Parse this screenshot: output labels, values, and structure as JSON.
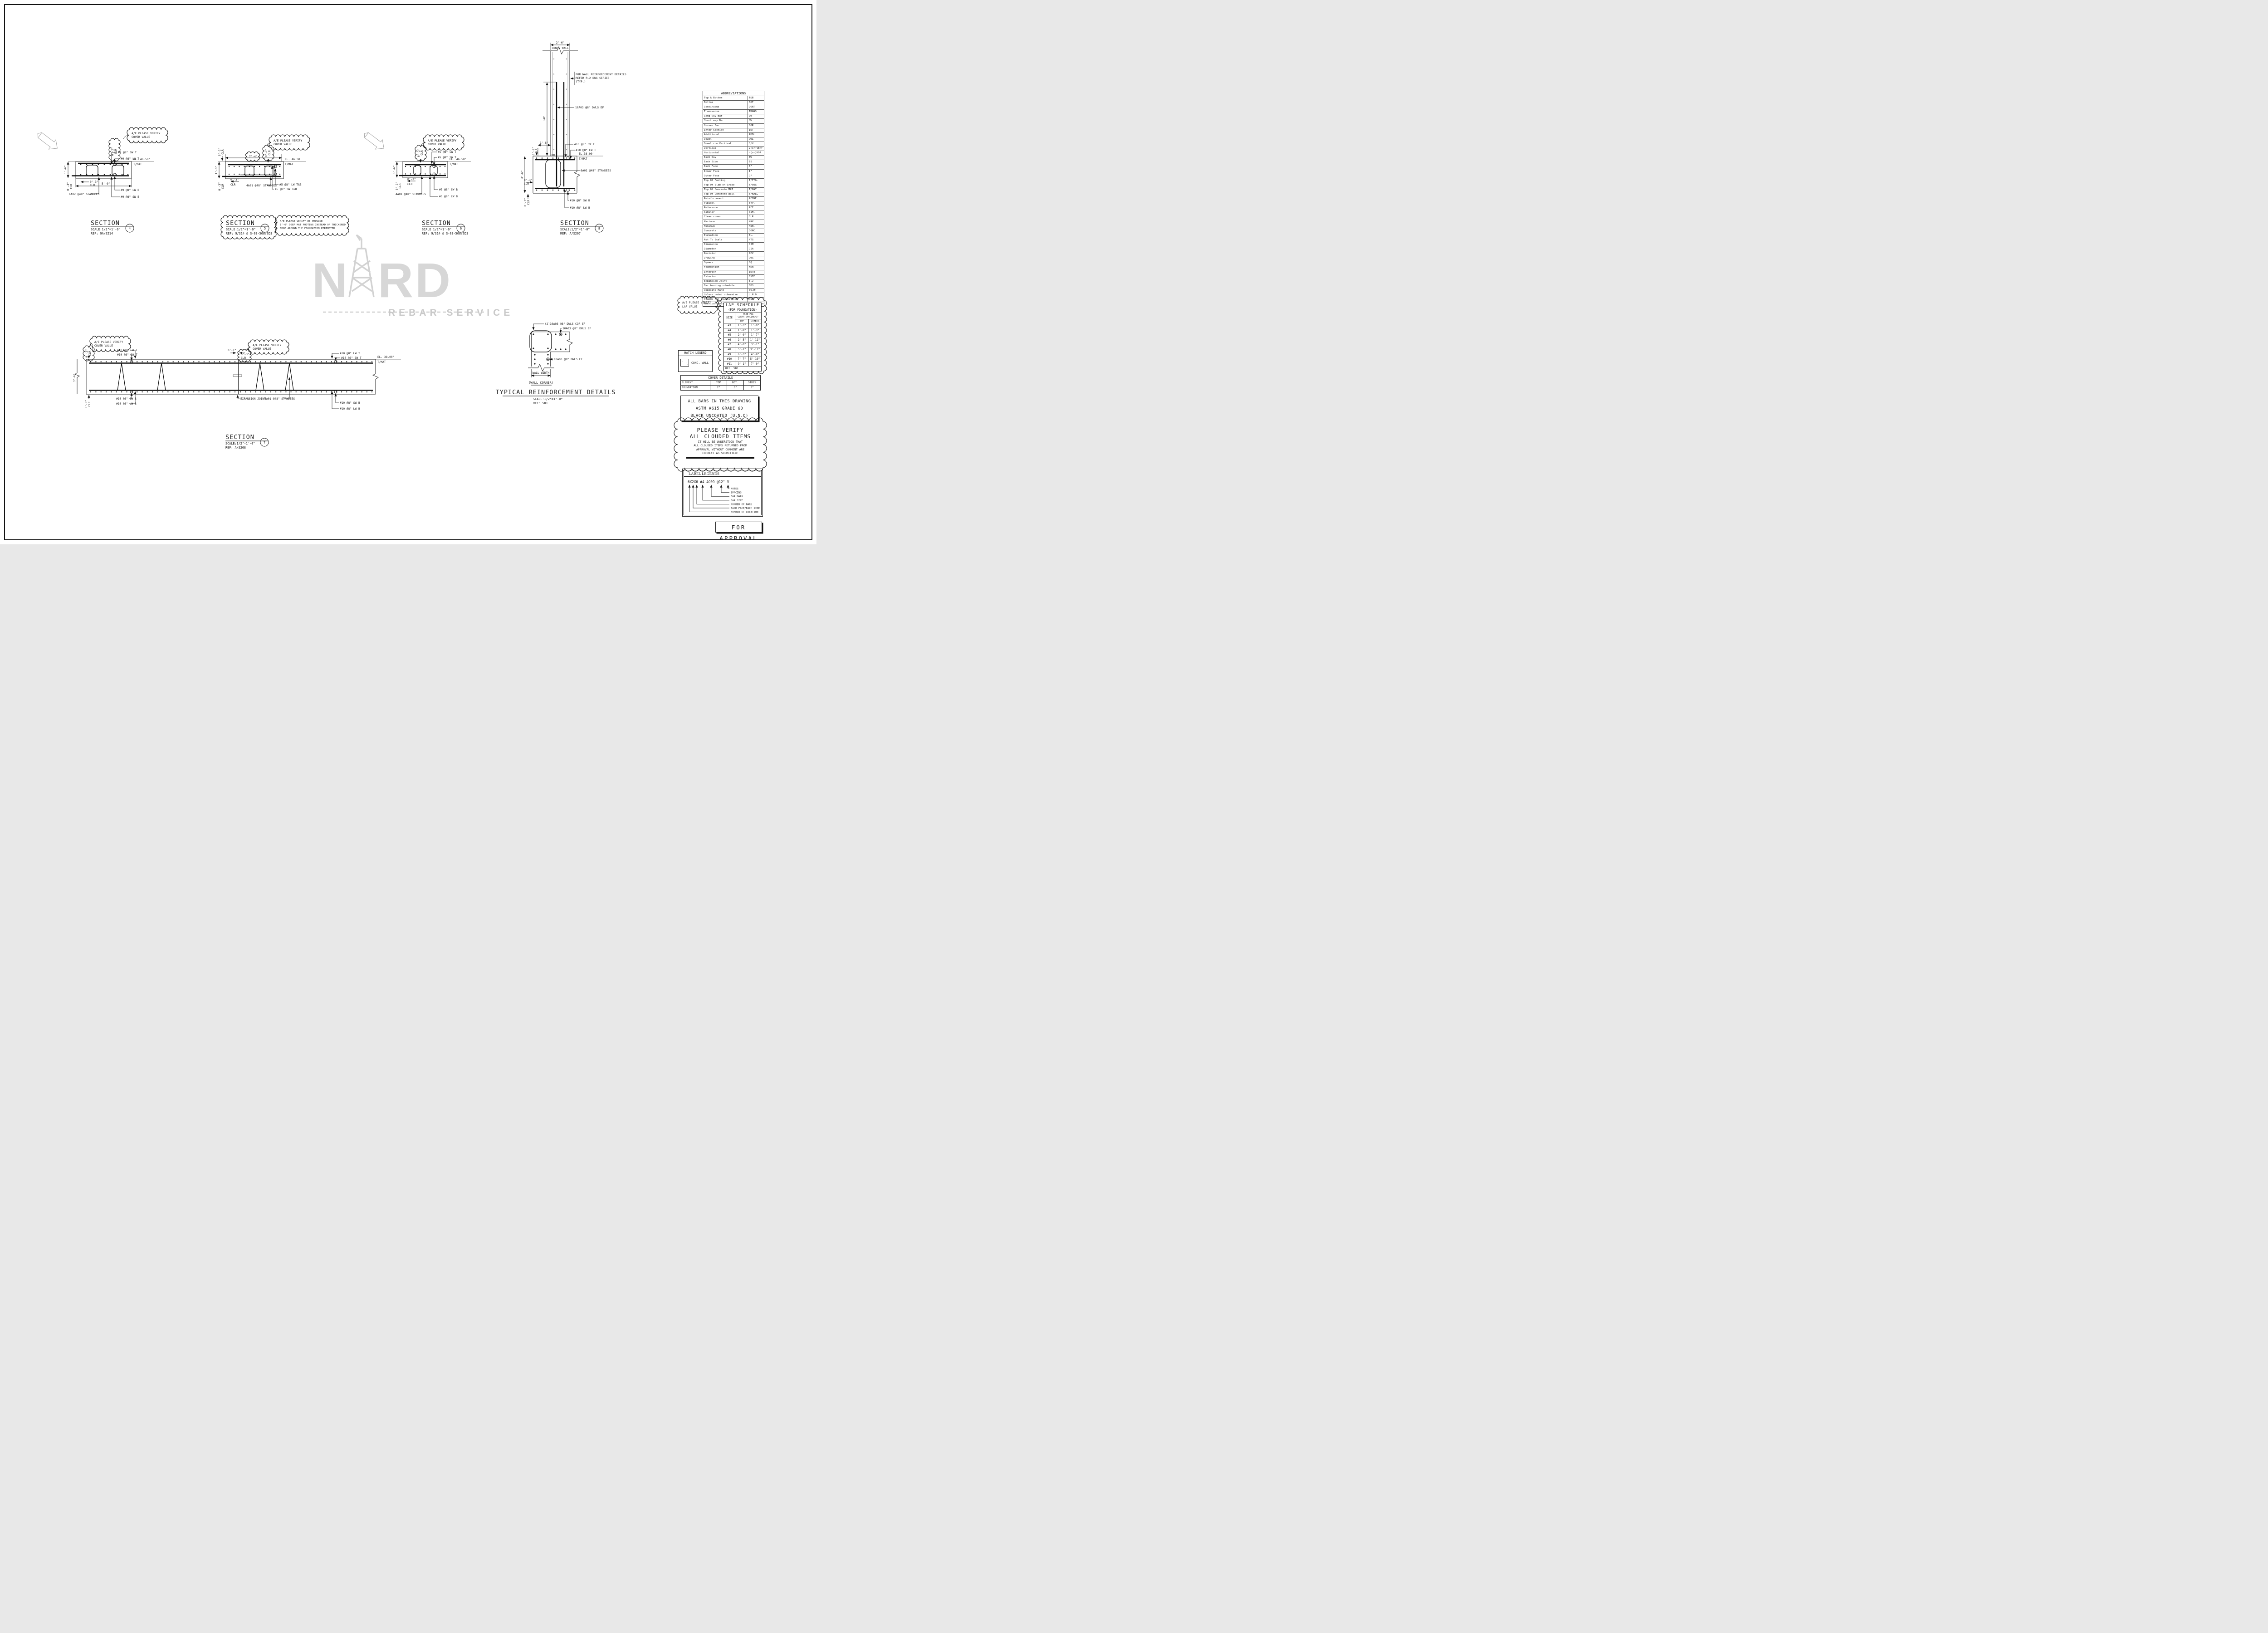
{
  "watermark": {
    "prefix": "N",
    "suffix": "RD",
    "subtitle": "REBAR SERVICE"
  },
  "clouds": {
    "verify1": "A/E PLEASE VERIFY",
    "verify2": "COVER VALUE",
    "lap1": "A/E PLEASE VERIFY",
    "lap2": "LAP VALUE"
  },
  "dims": {
    "clr02": "0'-2\"",
    "clr03": "0'-3\"",
    "clr": "CLR",
    "h16": "1'-6\"",
    "w50": "5'-0\"",
    "w74": "7'-4\"",
    "h36": "3'-6\"",
    "w26": "2'-6\"",
    "w01": "0'-1\"",
    "lap": "LAP",
    "wall_width": "WALL WIDTH"
  },
  "sections": {
    "s4": {
      "name": "SECTION",
      "num": "4",
      "scale": "SCALE:1/2\"=1'-0\"",
      "ref": "REF: 9A/S214",
      "sw_t": "#9 @8\" SW T",
      "lw_t": "#9 @8\" LW T",
      "lw_b": "#9 @8\" LW B",
      "sw_b": "#9 @8\" SW B",
      "standees": "6A02 @48\" STANDEES",
      "el": "EL. 46.50'",
      "tmat": "T/MAT"
    },
    "s5": {
      "name": "SECTION",
      "num": "5",
      "scale": "SCALE:1/2\"=1'-0\"",
      "ref": "REF: 9/S14 & S-03-508/SD3",
      "lw_tb": "#5 @8\" LW T&B",
      "sw_tb": "#5 @8\" SW T&B",
      "standees": "4A01 @48\" STANDEES",
      "el": "EL. 46.50'",
      "tmat": "T/MAT",
      "note1": "A/E PLEASE VERIFY WE PROVIDE",
      "note2": "1'-6\" DEEP MAT FOOTING INSTEAD OF THICKENED",
      "note3": "EDGE AROUND THE FOUNDATION PERIMETER"
    },
    "s6": {
      "name": "SECTION",
      "num": "6",
      "scale": "SCALE:1/2\"=1'-0\"",
      "ref": "REF: 9/S14 & S-03-508/SD3",
      "lw_t": "#5 @8\" LW T",
      "sw_t": "#5 @8\" SW T",
      "sw_b": "#5 @8\" SW B",
      "lw_b": "#5 @8\" LW B",
      "standees": "4A01 @48\" STANDEES",
      "el": "EL. 46.50'",
      "tmat": "T/MAT"
    },
    "s7": {
      "name": "SECTION",
      "num": "7",
      "scale": "SCALE:1/2\"=1'-0\"",
      "ref": "REF: A/S208",
      "lw_t": "#10 @8\" LW T",
      "sw_t": "#10 @8\" SW T",
      "sw_b": "#10 @8\" SW B",
      "lw_b": "#10 @8\" LW B",
      "standees": "6A01 @48\" STANDEES",
      "ej": "EXPANSION JOINT",
      "el": "EL. 38.00'",
      "tmat": "T/MAT"
    },
    "s8": {
      "name": "SECTION",
      "num": "8",
      "scale": "SCALE:1/2\"=1'-0\"",
      "ref": "REF: A/S207",
      "sw_t": "#10 @8\" SW T",
      "lw_t": "#10 @8\" LW T",
      "sw_b": "#10 @8\" SW B",
      "lw_b": "#10 @8\" LW B",
      "standees": "6A01 @48\" STANDEES",
      "dwls": "10A03 @8\" DWLS EF",
      "note1": "FOR WALL REINFORCEMENT DETAILS",
      "note2": "REFER R-2 DWG SERIES",
      "note3": "(TYP.)",
      "conc_wall": "CONC. WALL",
      "el": "EL.38.00'",
      "tmat": "T/MAT"
    },
    "corner": {
      "cor": "(2)10A03 @8\" DWLS COR EF",
      "ef_top": "10A03 @8\" DWLS EF",
      "ef_mid": "10A03 @8\" DWLS EF",
      "label": "(WALL CORNER)",
      "title": "TYPICAL REINFORCEMENT DETAILS",
      "scale": "SCALE:1/2\"=1'-0\"",
      "ref": "REF: SD1"
    }
  },
  "abbreviations": {
    "title": "ABBREVIATIONS",
    "rows": [
      [
        "Top & Bottom",
        "T&B"
      ],
      [
        "Bottom",
        "BOT"
      ],
      [
        "Continuous",
        "CONT"
      ],
      [
        "Transverse",
        "TRANS"
      ],
      [
        "Long way Bar",
        "LW"
      ],
      [
        "Short way Bar",
        "SW"
      ],
      [
        "Corner Bar",
        "COR"
      ],
      [
        "Inter Section",
        "INT"
      ],
      [
        "Additional",
        "ADDL"
      ],
      [
        "Dowel",
        "DWL"
      ],
      [
        "Dowel cum Vertical",
        "D/V"
      ],
      [
        "Vertical",
        "V(or)VERT"
      ],
      [
        "Horizontal",
        "H(or)HOR"
      ],
      [
        "Each Way",
        "EW"
      ],
      [
        "Each Side",
        "ES"
      ],
      [
        "Each Face",
        "EF"
      ],
      [
        "Inner Face",
        "IF"
      ],
      [
        "Outer Face",
        "OF"
      ],
      [
        "Top Of Footing",
        "T/FTG."
      ],
      [
        "Top Of Slab on Grade",
        "T/SOG"
      ],
      [
        "Top Of Concrete MAT",
        "T/MAT"
      ],
      [
        "Top Of Concrete Wall",
        "T/WALL"
      ],
      [
        "Reinforcement",
        "REINF."
      ],
      [
        "Typical",
        "TYP."
      ],
      [
        "Reference",
        "REF"
      ],
      [
        "Similar",
        "SIM."
      ],
      [
        "Clear cover",
        "CLR"
      ],
      [
        "Maximum",
        "MAX."
      ],
      [
        "Minimum",
        "MIN."
      ],
      [
        "Concrete",
        "CONC."
      ],
      [
        "Elevation",
        "EL."
      ],
      [
        "Not To Scale",
        "NTS"
      ],
      [
        "Dimension",
        "DIM"
      ],
      [
        "Diameter",
        "DIA"
      ],
      [
        "Revision",
        "REV"
      ],
      [
        "Drawing",
        "DWG"
      ],
      [
        "Square",
        "SQ"
      ],
      [
        "Foundation",
        "FDN"
      ],
      [
        "Interior",
        "INTE"
      ],
      [
        "Exterior",
        "EXTE"
      ],
      [
        "Expansion Joint",
        "E.J"
      ],
      [
        "Bar bending schedule",
        "BBS"
      ],
      [
        "Opposite Hand",
        "(O.H)"
      ],
      [
        "Unless noted otherwise",
        "U.N.O"
      ],
      [
        "Pounds Per Square Inch",
        "PSI"
      ],
      [
        "American Society of Testing and Materials",
        "ASTM"
      ]
    ]
  },
  "lap_schedule": {
    "title": "LAP SCHEDULE",
    "subtitle": "(FOR FOUNDATION)",
    "size": "SIZE",
    "hdr1": "4500 PSI",
    "hdr2": "CLEAR SPACING>3\"",
    "top": "TOP",
    "others": "OTHERS",
    "rows": [
      [
        "#3",
        "1'-3\"",
        "1'-0\""
      ],
      [
        "#4",
        "1'-8\"",
        "1'-3\""
      ],
      [
        "#5",
        "2'-0\"",
        "1'-7\""
      ],
      [
        "#6",
        "2'-5\"",
        "1'-11\""
      ],
      [
        "#7",
        "4'-0\"",
        "3'-1\""
      ],
      [
        "#8",
        "5'-1\"",
        "3'-11\""
      ],
      [
        "#9",
        "6'-3\"",
        "4'-9\""
      ],
      [
        "#10",
        "7'-7\"",
        "5'-10\""
      ],
      [
        "#11",
        "9'-1\"",
        "7'-0\""
      ]
    ],
    "ref": "REF:  SD1"
  },
  "hatch_legend": {
    "title": "HATCH LEGEND",
    "item": "CONC. WALL"
  },
  "cover_details": {
    "title": "COVER DETAILS",
    "headers": [
      "ELEMENT",
      "TOP",
      "BOT.",
      "SIDES"
    ],
    "row": [
      "FOUNDATION",
      "2\"",
      "3\"",
      "3\""
    ]
  },
  "astm_note": {
    "lines": [
      "ALL BARS IN THIS DRAWING",
      "ASTM A615 GRADE 60",
      "BLACK UNCOATED (U.N.O)"
    ]
  },
  "verify_note": {
    "big1": "PLEASE VERIFY",
    "big2": "ALL CLOUDED ITEMS",
    "small": [
      "IT WILL BE UNDERSTOOD THAT",
      "ALL CLOUDED ITEMS RETURNED FROM",
      "APPROVAL WITHOUT COMMENT ARE",
      "CORRECT AS SUBMITTED:"
    ]
  },
  "label_legends": {
    "title": "LABEL LEGENDS",
    "example": "6X2X6 #4 4C09 @12\" V",
    "items": [
      "NOTES",
      "SPACING",
      "BAR MARK",
      "BAR SIZE",
      "NUMBER OF BARS",
      "EACH FACE/EACH SIDE",
      "NUMBER OF LOCATION"
    ]
  },
  "approval": {
    "label": "FOR APPROVAL"
  }
}
